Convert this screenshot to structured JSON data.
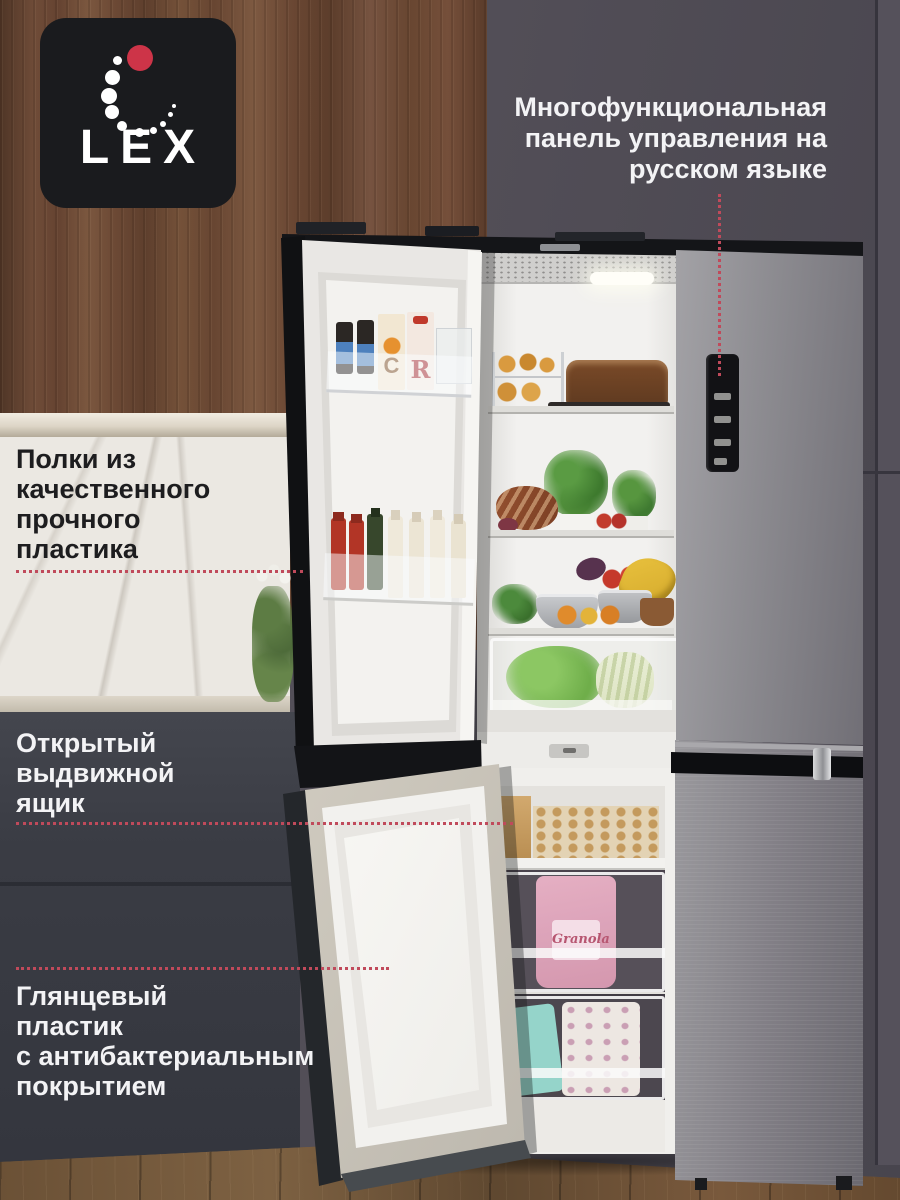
{
  "logo": {
    "text": "LEX"
  },
  "annotations": {
    "panel": {
      "lines": [
        "Многофункциональная",
        "панель управления на",
        "русском языке"
      ]
    },
    "shelves": {
      "lines": [
        "Полки из",
        "качественного",
        "прочного",
        "пластика"
      ]
    },
    "drawer": {
      "lines": [
        "Открытый",
        "выдвижной",
        "ящик"
      ]
    },
    "coating": {
      "lines": [
        "Глянцевый",
        "пластик",
        "с антибактериальным",
        "покрытием"
      ]
    }
  },
  "fridge": {
    "door_items": {
      "carton_left_letter": "C",
      "carton_right_letter": "R"
    },
    "freezer_items": {
      "pink_bag_label": "Granola",
      "teal_bag_label": "NUT GRANOLA"
    }
  },
  "palette": {
    "leader_line": "#c04a5b",
    "logo_background": "#1a1b1e",
    "logo_red_dot": "#cd3448",
    "annotation_light_text": "#f3f3f5",
    "annotation_dark_text": "#1d1d1f",
    "wall": "#524e57",
    "wood_cabinet": "#6e4c36",
    "marble_backsplash": "#ebe8e2",
    "lower_cabinet": "#3c3e46",
    "floor_wood": "#6f5438",
    "fridge_steel": "#8e8d92"
  }
}
